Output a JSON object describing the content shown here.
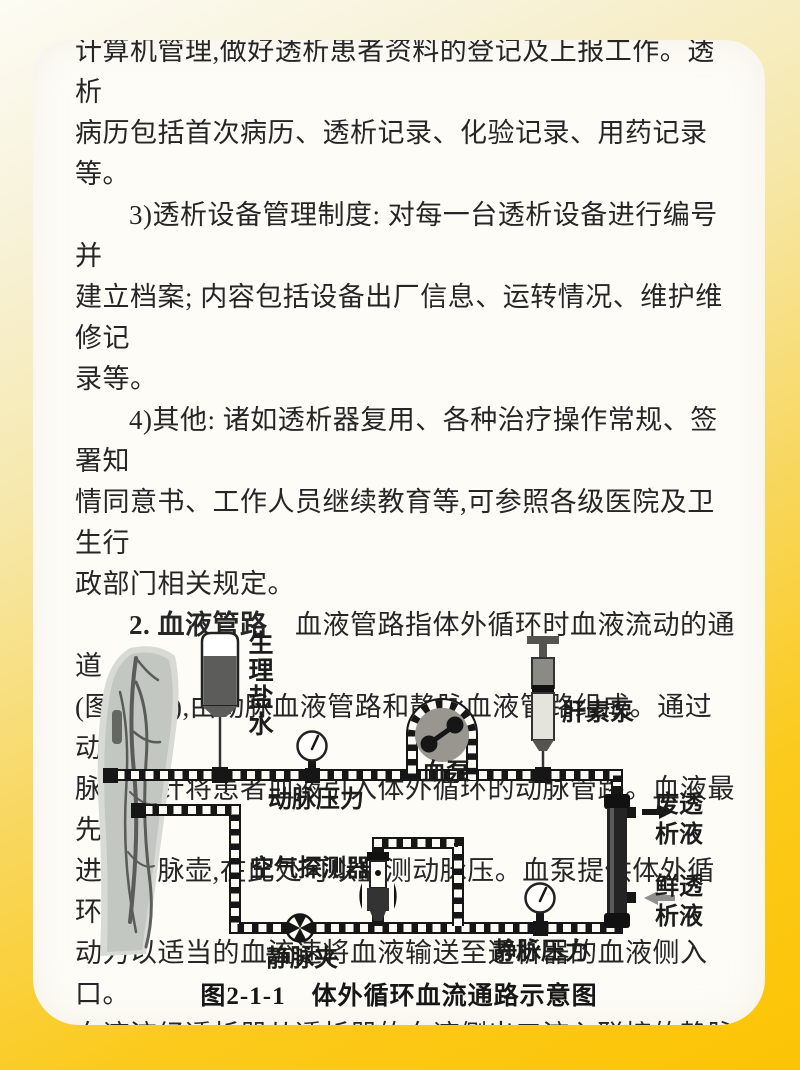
{
  "page": {
    "paragraphs": [
      {
        "text": "计算机管理,做好透析患者资料的登记及上报工作。透析\n病历包括首次病历、透析记录、化验记录、用药记录等。"
      },
      {
        "text": "3)透析设备管理制度: 对每一台透析设备进行编号并\n建立档案; 内容包括设备出厂信息、运转情况、维护维修记\n录等。"
      },
      {
        "text": "4)其他: 诸如透析器复用、各种治疗操作常规、签署知\n情同意书、工作人员继续教育等,可参照各级医院及卫生行\n政部门相关规定。"
      },
      {
        "lead": "2. 血液管路",
        "text": "　血液管路指体外循环时血液流动的通道\n(图2-1-1),由动脉血液管路和静脉血液管路组成。通过动\n脉穿刺针将患者血液引入体外循环的动脉管路。血液最先\n进入动脉壶,在此处可以监测动脉压。血泵提供体外循环\n动力以适当的血流速将血液输送至透析器的血液侧入口。\n血液流经透析器从透析器的血液侧出口流入联接的静脉血"
      }
    ]
  },
  "diagram": {
    "labels": {
      "saline": "生理盐水",
      "arterial_pressure": "动脉压力",
      "blood_pump": "血泵",
      "heparin_pump": "肝素泵",
      "waste_dialysate": "废透析液",
      "fresh_dialysate": "鲜透析液",
      "air_detector": "空气探测器",
      "venous_clamp": "静脉夹",
      "venous_pressure": "静脉压力"
    },
    "caption": "图2-1-1　体外循环血流通路示意图",
    "colors": {
      "frame_yellow": "#fcc405",
      "paper": "#fdfcf7",
      "ink": "#161616",
      "pump_gray": "#999690",
      "fresh_arrow_gray": "#8f8f8f"
    }
  }
}
